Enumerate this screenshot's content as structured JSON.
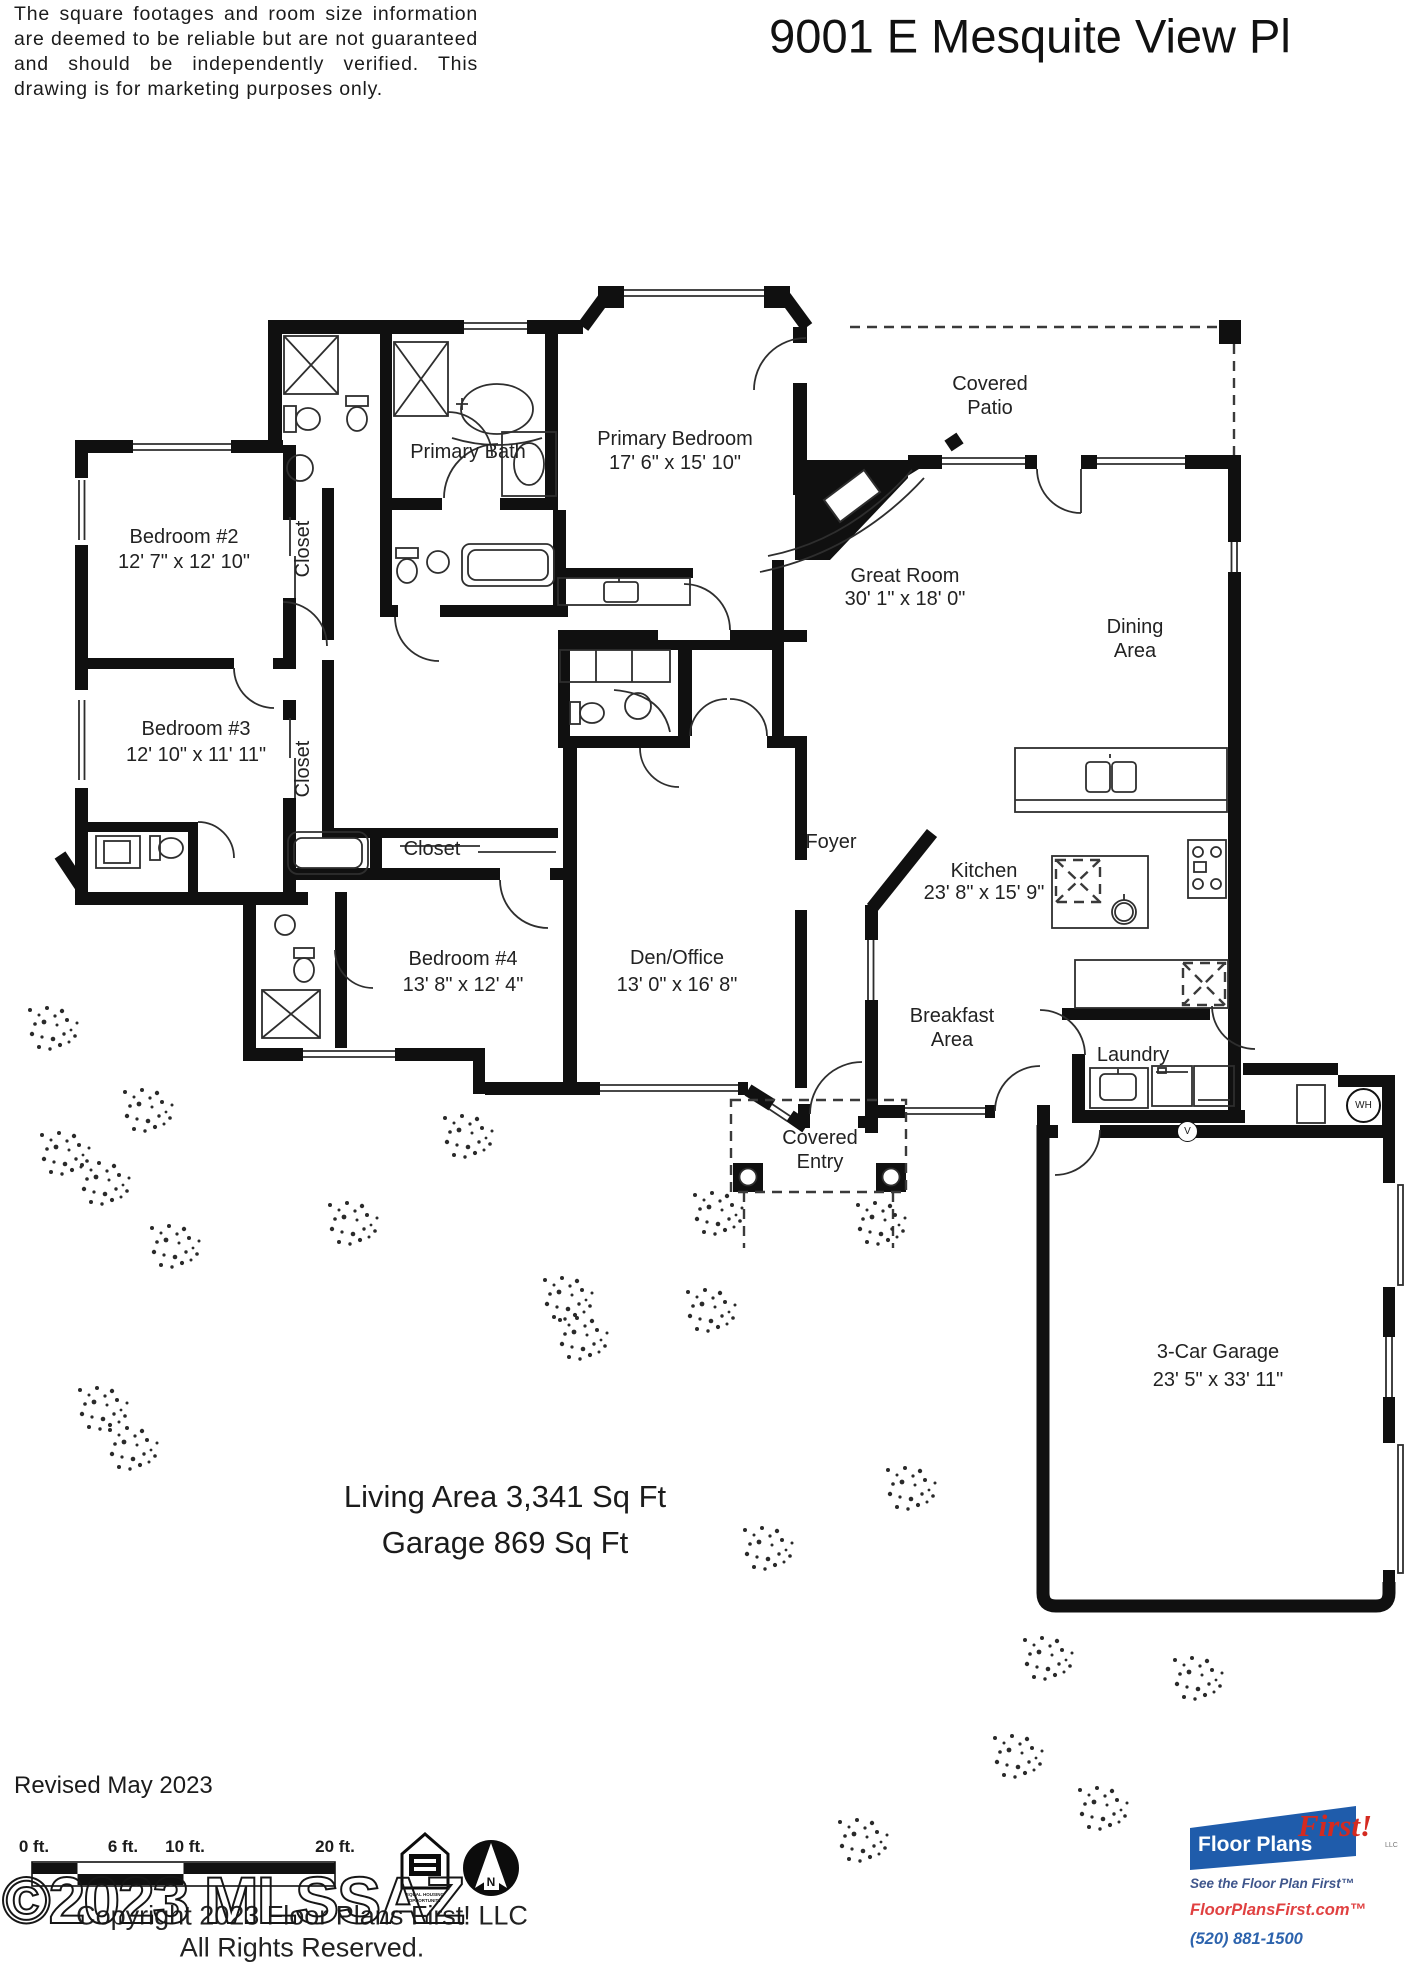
{
  "page": {
    "title": "9001 E Mesquite View Pl",
    "disclaimer": "The square footages and room size information are deemed to be reliable but are not guaranteed and should be independently verified. This drawing is for marketing purposes only."
  },
  "rooms": [
    {
      "id": "primary-bath",
      "label": "Primary Bath"
    },
    {
      "id": "primary-bedroom",
      "label": "Primary Bedroom",
      "dims": "17' 6\" x 15' 10\""
    },
    {
      "id": "covered-patio",
      "label": "Covered Patio"
    },
    {
      "id": "bedroom-2",
      "label": "Bedroom #2",
      "dims": "12' 7\" x 12' 10\""
    },
    {
      "id": "closet-bedroom-2",
      "label": "Closet"
    },
    {
      "id": "great-room",
      "label": "Great Room",
      "dims": "30' 1\" x 18' 0\""
    },
    {
      "id": "dining-area",
      "label": "Dining Area"
    },
    {
      "id": "bedroom-3",
      "label": "Bedroom #3",
      "dims": "12' 10\" x 11' 11\""
    },
    {
      "id": "closet-bedroom-3",
      "label": "Closet"
    },
    {
      "id": "hall-closet",
      "label": "Closet"
    },
    {
      "id": "foyer",
      "label": "Foyer"
    },
    {
      "id": "kitchen",
      "label": "Kitchen",
      "dims": "23' 8\" x 15' 9\""
    },
    {
      "id": "bedroom-4",
      "label": "Bedroom #4",
      "dims": "13' 8\" x 12' 4\""
    },
    {
      "id": "den-office",
      "label": "Den/Office",
      "dims": "13' 0\" x 16' 8\""
    },
    {
      "id": "breakfast-area",
      "label": "Breakfast Area"
    },
    {
      "id": "laundry",
      "label": "Laundry"
    },
    {
      "id": "covered-entry",
      "label": "Covered Entry"
    },
    {
      "id": "garage",
      "label": "3-Car Garage",
      "dims": "23' 5\" x 33' 11\""
    }
  ],
  "fixtures": {
    "water_heater": "WH",
    "vent": "V"
  },
  "areas": {
    "living": "Living Area 3,341 Sq Ft",
    "garage": "Garage 869 Sq Ft"
  },
  "footer": {
    "revised": "Revised May 2023",
    "watermark": "©2023 MLSSAZ",
    "copyright_line1": "Copyright 2023 Floor Plans First! LLC",
    "copyright_line2": "All Rights Reserved."
  },
  "scale_bar": {
    "labels": [
      "0 ft.",
      "6 ft.",
      "10 ft.",
      "20 ft."
    ]
  },
  "icons": {
    "equal_housing": "EQUAL HOUSING OPPORTUNITY",
    "north": "N"
  },
  "logo": {
    "name_part1": "Floor Plans",
    "name_part2": "First!",
    "llc": "LLC",
    "tagline": "See the Floor Plan First™",
    "website": "FloorPlansFirst.com™",
    "phone": "(520) 881-1500",
    "brand_blue": "#1f5cab",
    "brand_red": "#d42a20"
  }
}
